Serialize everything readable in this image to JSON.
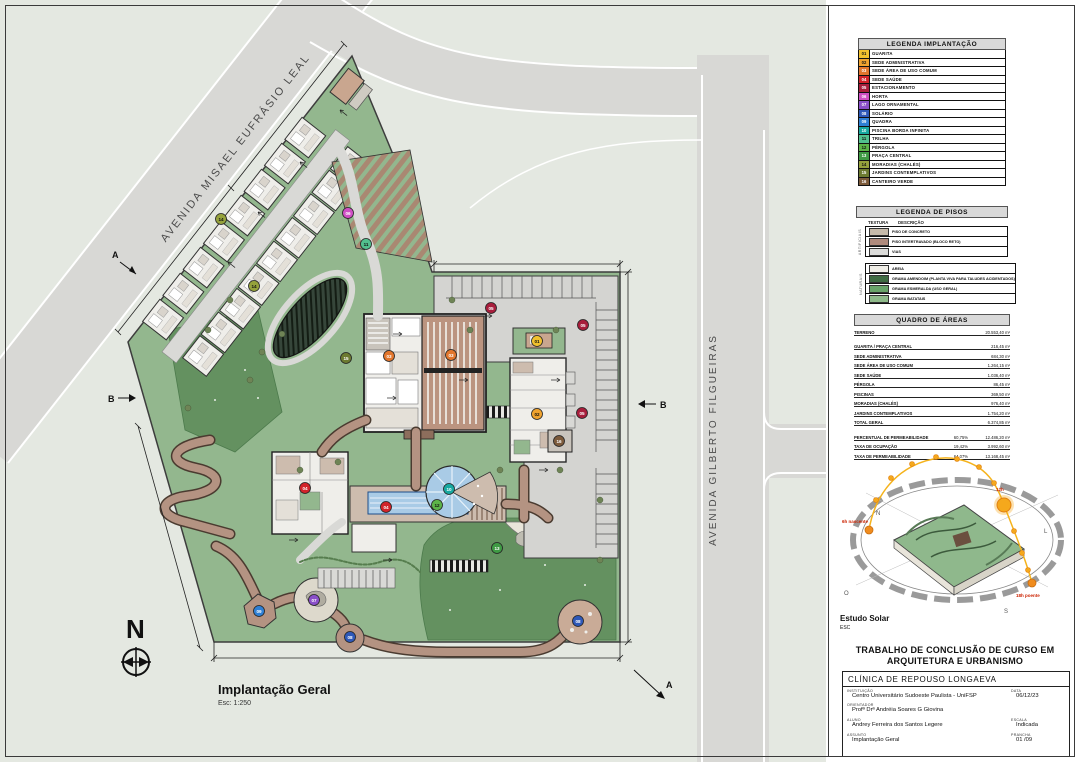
{
  "plan": {
    "title": "Implantação Geral",
    "scale_note": "Esc: 1:250",
    "north": "N",
    "section_a": "A",
    "section_b": "B",
    "street_1": "AVENIDA MISAEL EUFRÁSIO LEAL",
    "street_2": "AVENIDA GILBERTO FILGUEIRAS",
    "markers": [
      {
        "num": "01",
        "x": 537,
        "y": 341,
        "color": "#f2c12e",
        "tc": "#111"
      },
      {
        "num": "02",
        "x": 537,
        "y": 414,
        "color": "#f0a32f",
        "tc": "#111"
      },
      {
        "num": "03",
        "x": 389,
        "y": 356,
        "color": "#e2762d",
        "tc": "#fff"
      },
      {
        "num": "03",
        "x": 451,
        "y": 355,
        "color": "#e2762d",
        "tc": "#fff"
      },
      {
        "num": "04",
        "x": 305,
        "y": 488,
        "color": "#d2232a",
        "tc": "#fff"
      },
      {
        "num": "04",
        "x": 386,
        "y": 507,
        "color": "#d2232a",
        "tc": "#fff"
      },
      {
        "num": "05",
        "x": 491,
        "y": 308,
        "color": "#a81e3c",
        "tc": "#fff"
      },
      {
        "num": "05",
        "x": 583,
        "y": 325,
        "color": "#a81e3c",
        "tc": "#fff"
      },
      {
        "num": "05",
        "x": 582,
        "y": 413,
        "color": "#a81e3c",
        "tc": "#fff"
      },
      {
        "num": "06",
        "x": 348,
        "y": 213,
        "color": "#cf4fc4",
        "tc": "#fff"
      },
      {
        "num": "07",
        "x": 314,
        "y": 600,
        "color": "#8a4fc9",
        "tc": "#fff"
      },
      {
        "num": "08",
        "x": 350,
        "y": 637,
        "color": "#2e58b8",
        "tc": "#fff"
      },
      {
        "num": "08",
        "x": 578,
        "y": 621,
        "color": "#2e58b8",
        "tc": "#fff"
      },
      {
        "num": "09",
        "x": 259,
        "y": 611,
        "color": "#2f7fd4",
        "tc": "#fff"
      },
      {
        "num": "10",
        "x": 449,
        "y": 489,
        "color": "#17a8a0",
        "tc": "#fff"
      },
      {
        "num": "11",
        "x": 366,
        "y": 244,
        "color": "#52c08e",
        "tc": "#111"
      },
      {
        "num": "12",
        "x": 437,
        "y": 505,
        "color": "#5cb348",
        "tc": "#111"
      },
      {
        "num": "13",
        "x": 497,
        "y": 548,
        "color": "#3f9a44",
        "tc": "#fff"
      },
      {
        "num": "14",
        "x": 221,
        "y": 219,
        "color": "#95a23c",
        "tc": "#111"
      },
      {
        "num": "14",
        "x": 254,
        "y": 286,
        "color": "#95a23c",
        "tc": "#111"
      },
      {
        "num": "15",
        "x": 346,
        "y": 358,
        "color": "#6c7a30",
        "tc": "#fff"
      },
      {
        "num": "16",
        "x": 559,
        "y": 441,
        "color": "#7c5a3a",
        "tc": "#fff"
      }
    ]
  },
  "colors": {
    "site_green": "#93b78e",
    "lawn_dark": "#649160",
    "road": "#d8d8d5",
    "path_brown": "#b49382",
    "roof_tan": "#bb9480",
    "pool_blue": "#a9cbe6"
  },
  "legend_implantacao": {
    "title": "LEGENDA IMPLANTAÇÃO",
    "items": [
      {
        "num": "01",
        "label": "GUARITA",
        "color": "#f2c12e"
      },
      {
        "num": "02",
        "label": "SEDE ADMINISTRATIVA",
        "color": "#f0a32f"
      },
      {
        "num": "03",
        "label": "SEDE ÁREA DE USO COMUM",
        "color": "#e2762d"
      },
      {
        "num": "04",
        "label": "SEDE SAÚDE",
        "color": "#d2232a"
      },
      {
        "num": "05",
        "label": "ESTACIONAMENTO",
        "color": "#a81e3c"
      },
      {
        "num": "06",
        "label": "HORTA",
        "color": "#cf4fc4"
      },
      {
        "num": "07",
        "label": "LAGO ORNAMENTAL",
        "color": "#8a4fc9"
      },
      {
        "num": "08",
        "label": "SOLÁRIO",
        "color": "#2e58b8"
      },
      {
        "num": "09",
        "label": "QUADRA",
        "color": "#2f7fd4"
      },
      {
        "num": "10",
        "label": "PISCINA BORDA INFINITA",
        "color": "#17a8a0"
      },
      {
        "num": "11",
        "label": "TRILHA",
        "color": "#52c08e"
      },
      {
        "num": "12",
        "label": "PÉRGOLA",
        "color": "#5cb348"
      },
      {
        "num": "13",
        "label": "PRAÇA CENTRAL",
        "color": "#3f9a44"
      },
      {
        "num": "14",
        "label": "MORADIAS (CHALÉS)",
        "color": "#95a23c"
      },
      {
        "num": "15",
        "label": "JARDINS CONTEMPLATIVOS",
        "color": "#6c7a30"
      },
      {
        "num": "16",
        "label": "CANTEIRO VERDE",
        "color": "#7c5a3a"
      }
    ]
  },
  "legend_pisos": {
    "title": "LEGENDA DE PISOS",
    "col_texture": "TEXTURA",
    "col_desc": "DESCRIÇÃO",
    "groups": [
      {
        "name": "ARTIFICIAIS",
        "rows": [
          {
            "desc": "PISO DE CONCRETO",
            "color": "#c7bbab"
          },
          {
            "desc": "PISO INTERTRAVADO (BLOCO RETO)",
            "color": "#b08b7d"
          },
          {
            "desc": "VIAS",
            "color": "#dcdcda"
          }
        ]
      },
      {
        "name": "NATURAIS",
        "rows": [
          {
            "desc": "AREIA",
            "color": "#efede6"
          },
          {
            "desc": "GRAMA AMENDOIM (PLANTA VIVA PARA TALUDES ACIDENTADOS)",
            "color": "#3f6b42"
          },
          {
            "desc": "GRAMA ESMERALDA (USO GERAL)",
            "color": "#69a469"
          },
          {
            "desc": "GRAMA BATATAIS",
            "color": "#8fba8a"
          }
        ]
      }
    ]
  },
  "quadro_areas": {
    "title": "QUADRO DE ÁREAS",
    "rows": [
      {
        "name": "TERRENO",
        "pct": "",
        "area": "20.553,40 m²"
      },
      {
        "name": "GUARITA / PRAÇA CENTRAL",
        "pct": "",
        "area": "216,45 m²"
      },
      {
        "name": "SEDE ADMINISTRATIVA",
        "pct": "",
        "area": "684,30 m²"
      },
      {
        "name": "SEDE ÁREA DE USO COMUM",
        "pct": "",
        "area": "1.264,15 m²"
      },
      {
        "name": "SEDE SAÚDE",
        "pct": "",
        "area": "1.036,40 m²"
      },
      {
        "name": "PÉRGOLA",
        "pct": "",
        "area": "86,45 m²"
      },
      {
        "name": "PISCINAS",
        "pct": "",
        "area": "369,50 m²"
      },
      {
        "name": "MORADIAS (CHALÉS)",
        "pct": "",
        "area": "976,40 m²"
      },
      {
        "name": "JARDINS CONTEMPLATIVOS",
        "pct": "",
        "area": "1.754,20 m²"
      },
      {
        "name": "TOTAL GERAL",
        "pct": "",
        "area": "6.374,85 m²"
      },
      {
        "name": "PERCENTUAL DE PERMEABILIDADE",
        "pct": "60,75%",
        "area": "12.486,20 m²"
      },
      {
        "name": "TAXA DE OCUPAÇÃO",
        "pct": "19,42%",
        "area": "3.992,60 m²"
      },
      {
        "name": "TAXA DE PERMEABILIDADE",
        "pct": "64,07%",
        "area": "13.168,45 m²"
      }
    ]
  },
  "estudo_solar": {
    "title": "Estudo Solar",
    "scale_note": "ESC",
    "n": "N",
    "s": "S",
    "l": "L",
    "o": "O",
    "label_left": "6h nascente",
    "label_top": "12h",
    "label_right": "18h poente"
  },
  "title_block": {
    "header_line1": "TRABALHO DE CONCLUSÃO DE CURSO EM",
    "header_line2": "ARQUITETURA E URBANISMO",
    "project": "CLÍNICA DE REPOUSO LONGAEVA",
    "instituicao_label": "INSTITUIÇÃO",
    "instituicao": "Centro Universitário Sudoeste Paulista - UniFSP",
    "data_label": "DATA",
    "data": "06/12/23",
    "orientador_label": "ORIENTADOR",
    "orientador": "Profª Drª Andréia Soares G Giovina",
    "aluno_label": "ALUNO",
    "aluno": "Andrey Ferreira dos Santos Legere",
    "escala_label": "ESCALA",
    "escala": "Indicada",
    "assunto_label": "ASSUNTO",
    "assunto": "Implantação Geral",
    "prancha_label": "PRANCHA",
    "prancha": "01 /09"
  }
}
